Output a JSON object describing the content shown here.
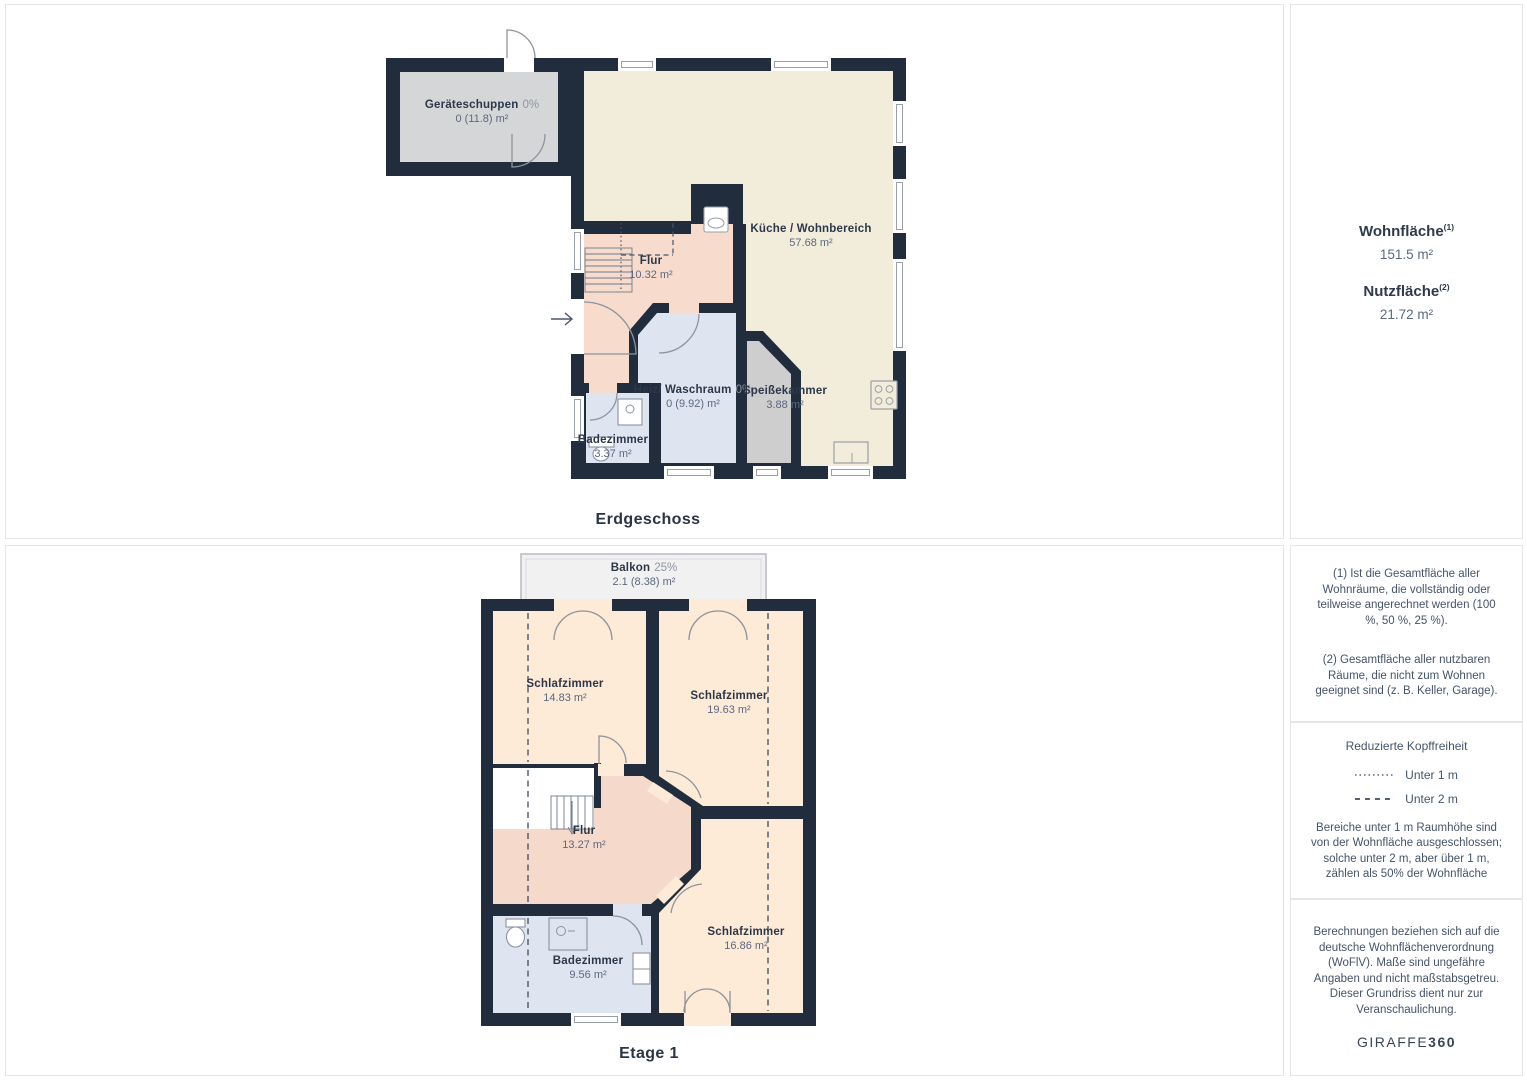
{
  "floors": [
    {
      "caption": "Erdgeschoss",
      "rooms": [
        {
          "name": "Geräteschuppen",
          "pct": "0%",
          "area": "0 (11.8) m²"
        },
        {
          "name": "Küche / Wohnbereich",
          "pct": "",
          "area": "57.68 m²"
        },
        {
          "name": "Flur",
          "pct": "",
          "area": "10.32 m²"
        },
        {
          "name": "Heiz/ Waschraum",
          "pct": "0%",
          "area": "0 (9.92) m²"
        },
        {
          "name": "Speißekammer",
          "pct": "",
          "area": "3.88 m²"
        },
        {
          "name": "Badezimmer",
          "pct": "",
          "area": "3.37 m²"
        }
      ]
    },
    {
      "caption": "Etage 1",
      "rooms": [
        {
          "name": "Balkon",
          "pct": "25%",
          "area": "2.1 (8.38) m²"
        },
        {
          "name": "Schlafzimmer",
          "pct": "",
          "area": "14.83 m²"
        },
        {
          "name": "Schlafzimmer",
          "pct": "",
          "area": "19.63 m²"
        },
        {
          "name": "Flur",
          "pct": "",
          "area": "13.27 m²"
        },
        {
          "name": "Badezimmer",
          "pct": "",
          "area": "9.56 m²"
        },
        {
          "name": "Schlafzimmer",
          "pct": "",
          "area": "16.86 m²"
        }
      ]
    }
  ],
  "sidebar": {
    "wohnflaeche_label": "Wohnfläche",
    "wohnflaeche_sup": "(1)",
    "wohnflaeche_value": "151.5 m²",
    "nutzflaeche_label": "Nutzfläche",
    "nutzflaeche_sup": "(2)",
    "nutzflaeche_value": "21.72 m²",
    "footnote1": "(1) Ist die Gesamtfläche aller Wohnräume, die vollständig oder teilweise angerechnet werden (100 %, 50 %, 25 %).",
    "footnote2": "(2) Gesamtfläche aller nutzbaren Räume, die nicht zum Wohnen geeignet sind (z. B. Keller, Garage).",
    "legend_title": "Reduzierte Kopffreiheit",
    "legend_items": [
      {
        "style": "dotted",
        "label": "Unter 1 m"
      },
      {
        "style": "dashed",
        "label": "Unter 2 m"
      }
    ],
    "legend_note": "Bereiche unter 1 m Raumhöhe sind von der Wohnfläche ausgeschlossen; solche unter 2 m, aber über 1 m, zählen als 50% der Wohnfläche",
    "disclaimer": "Berechnungen beziehen sich auf die deutsche Wohnflächenverordnung (WoFlV). Maße sind ungefähre Angaben und nicht maßstabsgetreu. Dieser Grundriss dient nur zur Veranschaulichung.",
    "brand_left": "GIRAFFE",
    "brand_right": "360"
  },
  "colors": {
    "wall": "#212c3d",
    "kitchen": "#f2ecda",
    "hall": "#f7dccd",
    "bedroom": "#fdead7",
    "bath": "#dfe5f0",
    "shed": "#d5d6d7",
    "pantry": "#cdcecd",
    "balcony": "#f1f1f2"
  }
}
